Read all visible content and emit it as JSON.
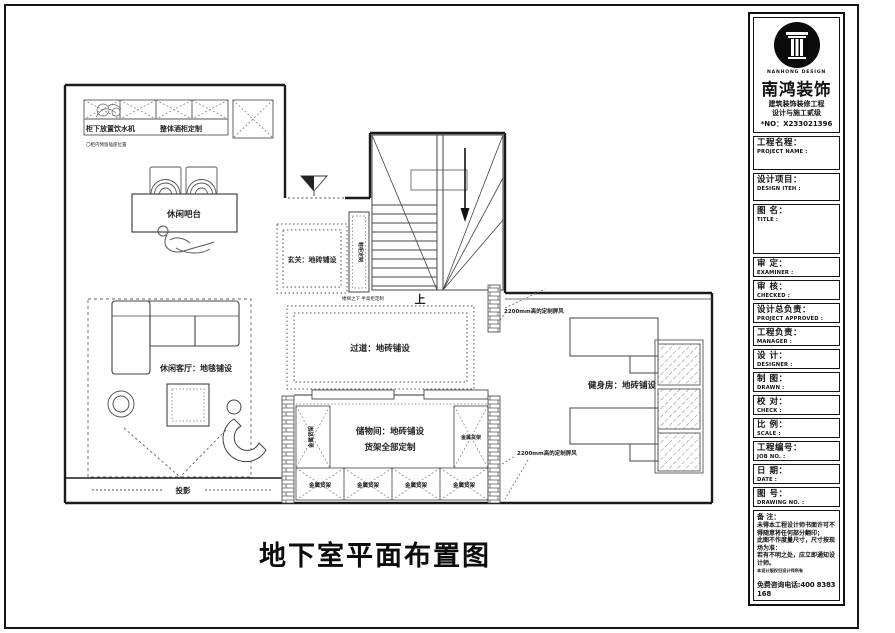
{
  "plan": {
    "title": "地下室平面布置图",
    "labels": {
      "cabinet_note": "柜下放置饮水机",
      "cabinet_custom": "整体酒柜定制",
      "tiny_note": "〇柜内预留插座位置",
      "bar_table": "休闲吧台",
      "entry": "玄关：地砖铺设",
      "shoe_cabinet": "鞋柜定制",
      "under_stair_note": "楼梯之下 半高柜定制",
      "stairs_up": "上",
      "corridor": "过道：地砖铺设",
      "living": "休闲客厅：地毯铺设",
      "projection": "投影",
      "storage_line1": "储物间：地砖铺设",
      "storage_line2": "货架全部定制",
      "metal_shelf": "金属货架",
      "gym": "健身房：地砖铺设",
      "screen_note": "2200mm高的定制屏风"
    }
  },
  "titleblock": {
    "brand": {
      "en": "NANHONG DESIGN",
      "zh": "南鸿装饰",
      "line1": "建筑装饰装修工程",
      "line2": "设计与施工贰级",
      "no": "*NO：X233021396"
    },
    "fields": [
      {
        "zh": "工程名程：",
        "en": "PROJECT NAME :"
      },
      {
        "zh": "设计项目：",
        "en": "DESIGN ITEH :"
      },
      {
        "zh": "图 名：",
        "en": "TITLE :"
      },
      {
        "zh": "审 定：",
        "en": "EXAMINER :"
      },
      {
        "zh": "审 核：",
        "en": "CHECKED :"
      },
      {
        "zh": "设计总负责：",
        "en": "PROJECT APPROVED :"
      },
      {
        "zh": "工程负责：",
        "en": "MANAGER :"
      },
      {
        "zh": "设 计：",
        "en": "DESIGNER :"
      },
      {
        "zh": "制 图：",
        "en": "DRAWN :"
      },
      {
        "zh": "校 对：",
        "en": "CHECK :"
      },
      {
        "zh": "比 例：",
        "en": "SCALE :"
      },
      {
        "zh": "工程编号：",
        "en": "JOB NO. :"
      },
      {
        "zh": "日 期：",
        "en": "DATE :"
      },
      {
        "zh": "图 号：",
        "en": "DRAWING NO. :"
      }
    ],
    "notes": {
      "title": "备 注：",
      "line1": "未得本工程设计师书面许可不得随意将任何部分翻印；",
      "line2": "此图不作度量尺寸，尺寸按现场为准：",
      "line3": "若有不明之处，应立即通知设计师。",
      "tiny": "本设计版权归设计师所有",
      "phone": "免费咨询电话:400 8383 168"
    }
  }
}
